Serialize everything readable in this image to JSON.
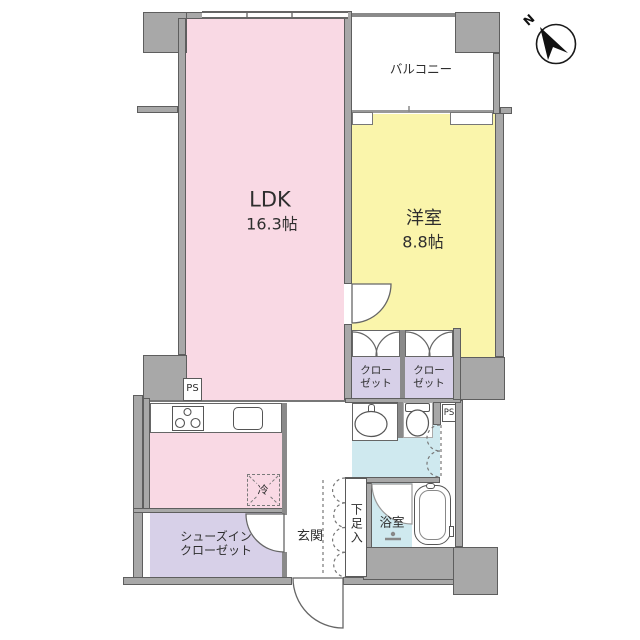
{
  "rooms": {
    "ldk": {
      "name": "LDK",
      "area": "16.3帖"
    },
    "western_room": {
      "name": "洋室",
      "area": "8.8帖"
    },
    "balcony": {
      "name": "バルコニー"
    },
    "closet_left": {
      "name_line1": "クロー",
      "name_line2": "ゼット"
    },
    "closet_right": {
      "name_line1": "クロー",
      "name_line2": "ゼット"
    },
    "shoe_closet": {
      "name_line1": "シューズイン",
      "name_line2": "クローゼット"
    },
    "entrance": {
      "name": "玄関"
    },
    "shoe_cabinet": {
      "name": "下足入"
    },
    "bathroom": {
      "name": "浴室"
    }
  },
  "fixtures": {
    "refrigerator_label": "冷",
    "pipe_space_left": "PS",
    "pipe_space_right": "PS"
  },
  "compass": {
    "north_label": "N"
  },
  "colors": {
    "ldk": "#f9d9e4",
    "western": "#faf5ab",
    "closet": "#d7d0e8",
    "water": "#cfe9ef",
    "wall": "#a8a8a8",
    "wallline": "#5e5e5e"
  }
}
